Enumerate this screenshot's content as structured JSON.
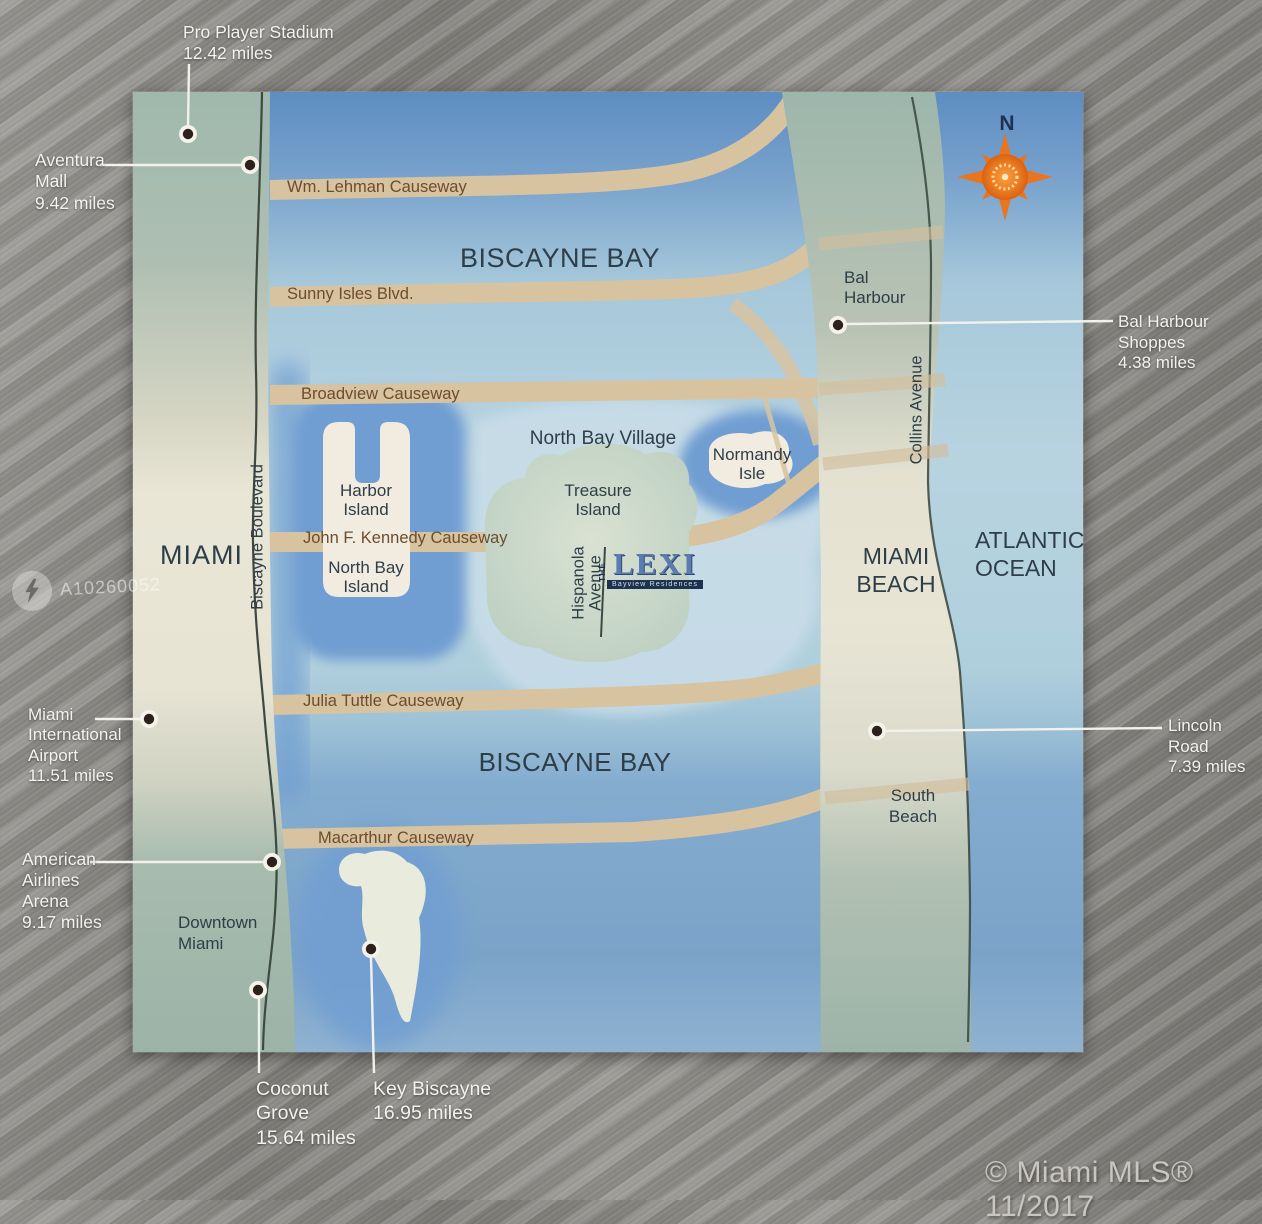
{
  "photo": {
    "listing_watermark": "A10260052",
    "mls_watermark": "© Miami MLS® 11/2017"
  },
  "compass": {
    "north": "N"
  },
  "map": {
    "water": {
      "biscayne_bay_north": "BISCAYNE BAY",
      "biscayne_bay_south": "BISCAYNE BAY",
      "atlantic_ocean": "ATLANTIC\nOCEAN"
    },
    "regions": {
      "miami": "MIAMI",
      "miami_beach": "MIAMI\nBEACH",
      "north_bay_village": "North Bay Village",
      "bal_harbour": "Bal\nHarbour",
      "south_beach": "South\nBeach",
      "downtown_miami": "Downtown\nMiami"
    },
    "islands": {
      "harbor_island": "Harbor\nIsland",
      "north_bay_island": "North Bay\nIsland",
      "treasure_island": "Treasure\nIsland",
      "normandy_isle": "Normandy\nIsle"
    },
    "roads": {
      "wm_lehman_causeway": "Wm. Lehman Causeway",
      "sunny_isles_blvd": "Sunny Isles Blvd.",
      "broadview_causeway": "Broadview Causeway",
      "john_f_kennedy_causeway": "John F. Kennedy Causeway",
      "julia_tuttle_causeway": "Julia Tuttle Causeway",
      "macarthur_causeway": "Macarthur Causeway",
      "biscayne_boulevard": "Biscayne Boulevard",
      "collins_avenue": "Collins Avenue",
      "hispanola_avenue": "Hispanola\nAvenue"
    },
    "property": {
      "prefix": "THE",
      "name": "LEXI",
      "tagline": "Bayview Residences"
    }
  },
  "callouts": {
    "pro_player_stadium": {
      "name": "Pro Player Stadium",
      "distance": "12.42 miles"
    },
    "aventura_mall": {
      "name": "Aventura\nMall",
      "distance": "9.42 miles"
    },
    "bal_harbour_shoppes": {
      "name": "Bal Harbour\nShoppes",
      "distance": "4.38 miles"
    },
    "miami_international_airport": {
      "name": "Miami\nInternational\nAirport",
      "distance": "11.51 miles"
    },
    "lincoln_road": {
      "name": "Lincoln\nRoad",
      "distance": "7.39 miles"
    },
    "american_airlines_arena": {
      "name": "American\nAirlines\nArena",
      "distance": "9.17 miles"
    },
    "coconut_grove": {
      "name": "Coconut\nGrove",
      "distance": "15.64 miles"
    },
    "key_biscayne": {
      "name": "Key Biscayne",
      "distance": "16.95 miles"
    }
  },
  "colors": {
    "bay_deep_blue": "#5d8dc2",
    "bay_pale_blue": "#b8d3e0",
    "land_green": "#9fb7ac",
    "land_cream": "#e9e6d6",
    "causeway_tan": "#d8c3a0",
    "island_white": "#f1ecdf",
    "treasure_green": "#c6d5c7",
    "label_slate": "#2e3e48",
    "road_label_brown": "#6d4c2e",
    "compass_orange": "#e8751f",
    "leader_line_white": "#f2f1ec"
  }
}
